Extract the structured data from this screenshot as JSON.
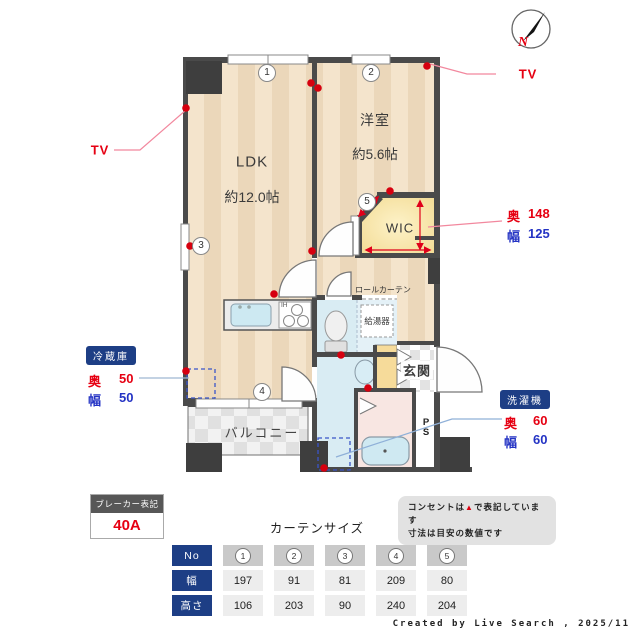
{
  "colors": {
    "accent_navy": "#1d3e85",
    "red": "#e60012",
    "blue": "#2433c4",
    "wall": "#4a4a4a",
    "floor_stripe_light": "#f4e4cc",
    "floor_stripe_dark": "#ebd7ba",
    "wet_floor": "#d9ecf3",
    "bath_floor": "#f8e6e2",
    "wic_yellow": "#f7e2a2"
  },
  "compass": {
    "north": "N"
  },
  "plan": {
    "ldk": {
      "name": "LDK",
      "size": "約12.0帖"
    },
    "bedroom": {
      "name": "洋室",
      "size": "約5.6帖"
    },
    "wic_label": "WIC",
    "entrance_label": "玄関",
    "balcony_label": "バルコニー",
    "ps_label": "PS",
    "water_heater_label": "給湯器",
    "roll_curtain_label": "ロールカーテン",
    "ih_label": "IH",
    "window_numbers": [
      "1",
      "2",
      "3",
      "4",
      "5"
    ],
    "tv_left": "TV",
    "tv_right": "TV",
    "wic_dims": {
      "depth_label": "奥",
      "depth_value": "148",
      "width_label": "幅",
      "width_value": "125"
    },
    "fridge": {
      "name": "冷蔵庫",
      "depth_label": "奥",
      "depth_value": "50",
      "width_label": "幅",
      "width_value": "50"
    },
    "washer": {
      "name": "洗濯機",
      "depth_label": "奥",
      "depth_value": "60",
      "width_label": "幅",
      "width_value": "60"
    }
  },
  "breaker": {
    "title": "ブレーカー表記",
    "value": "40A"
  },
  "note": {
    "line1_pre": "コンセントは",
    "line1_symbol": "▲",
    "line1_post": "で表記しています",
    "line2": "寸法は目安の数値です"
  },
  "curtains": {
    "title": "カーテンサイズ",
    "row_no": "No",
    "row_width": "幅",
    "row_height": "高さ",
    "numbers": [
      "1",
      "2",
      "3",
      "4",
      "5"
    ],
    "widths": [
      "197",
      "91",
      "81",
      "209",
      "80"
    ],
    "heights": [
      "106",
      "203",
      "90",
      "240",
      "204"
    ]
  },
  "credit": "Created by Live Search , 2025/11"
}
